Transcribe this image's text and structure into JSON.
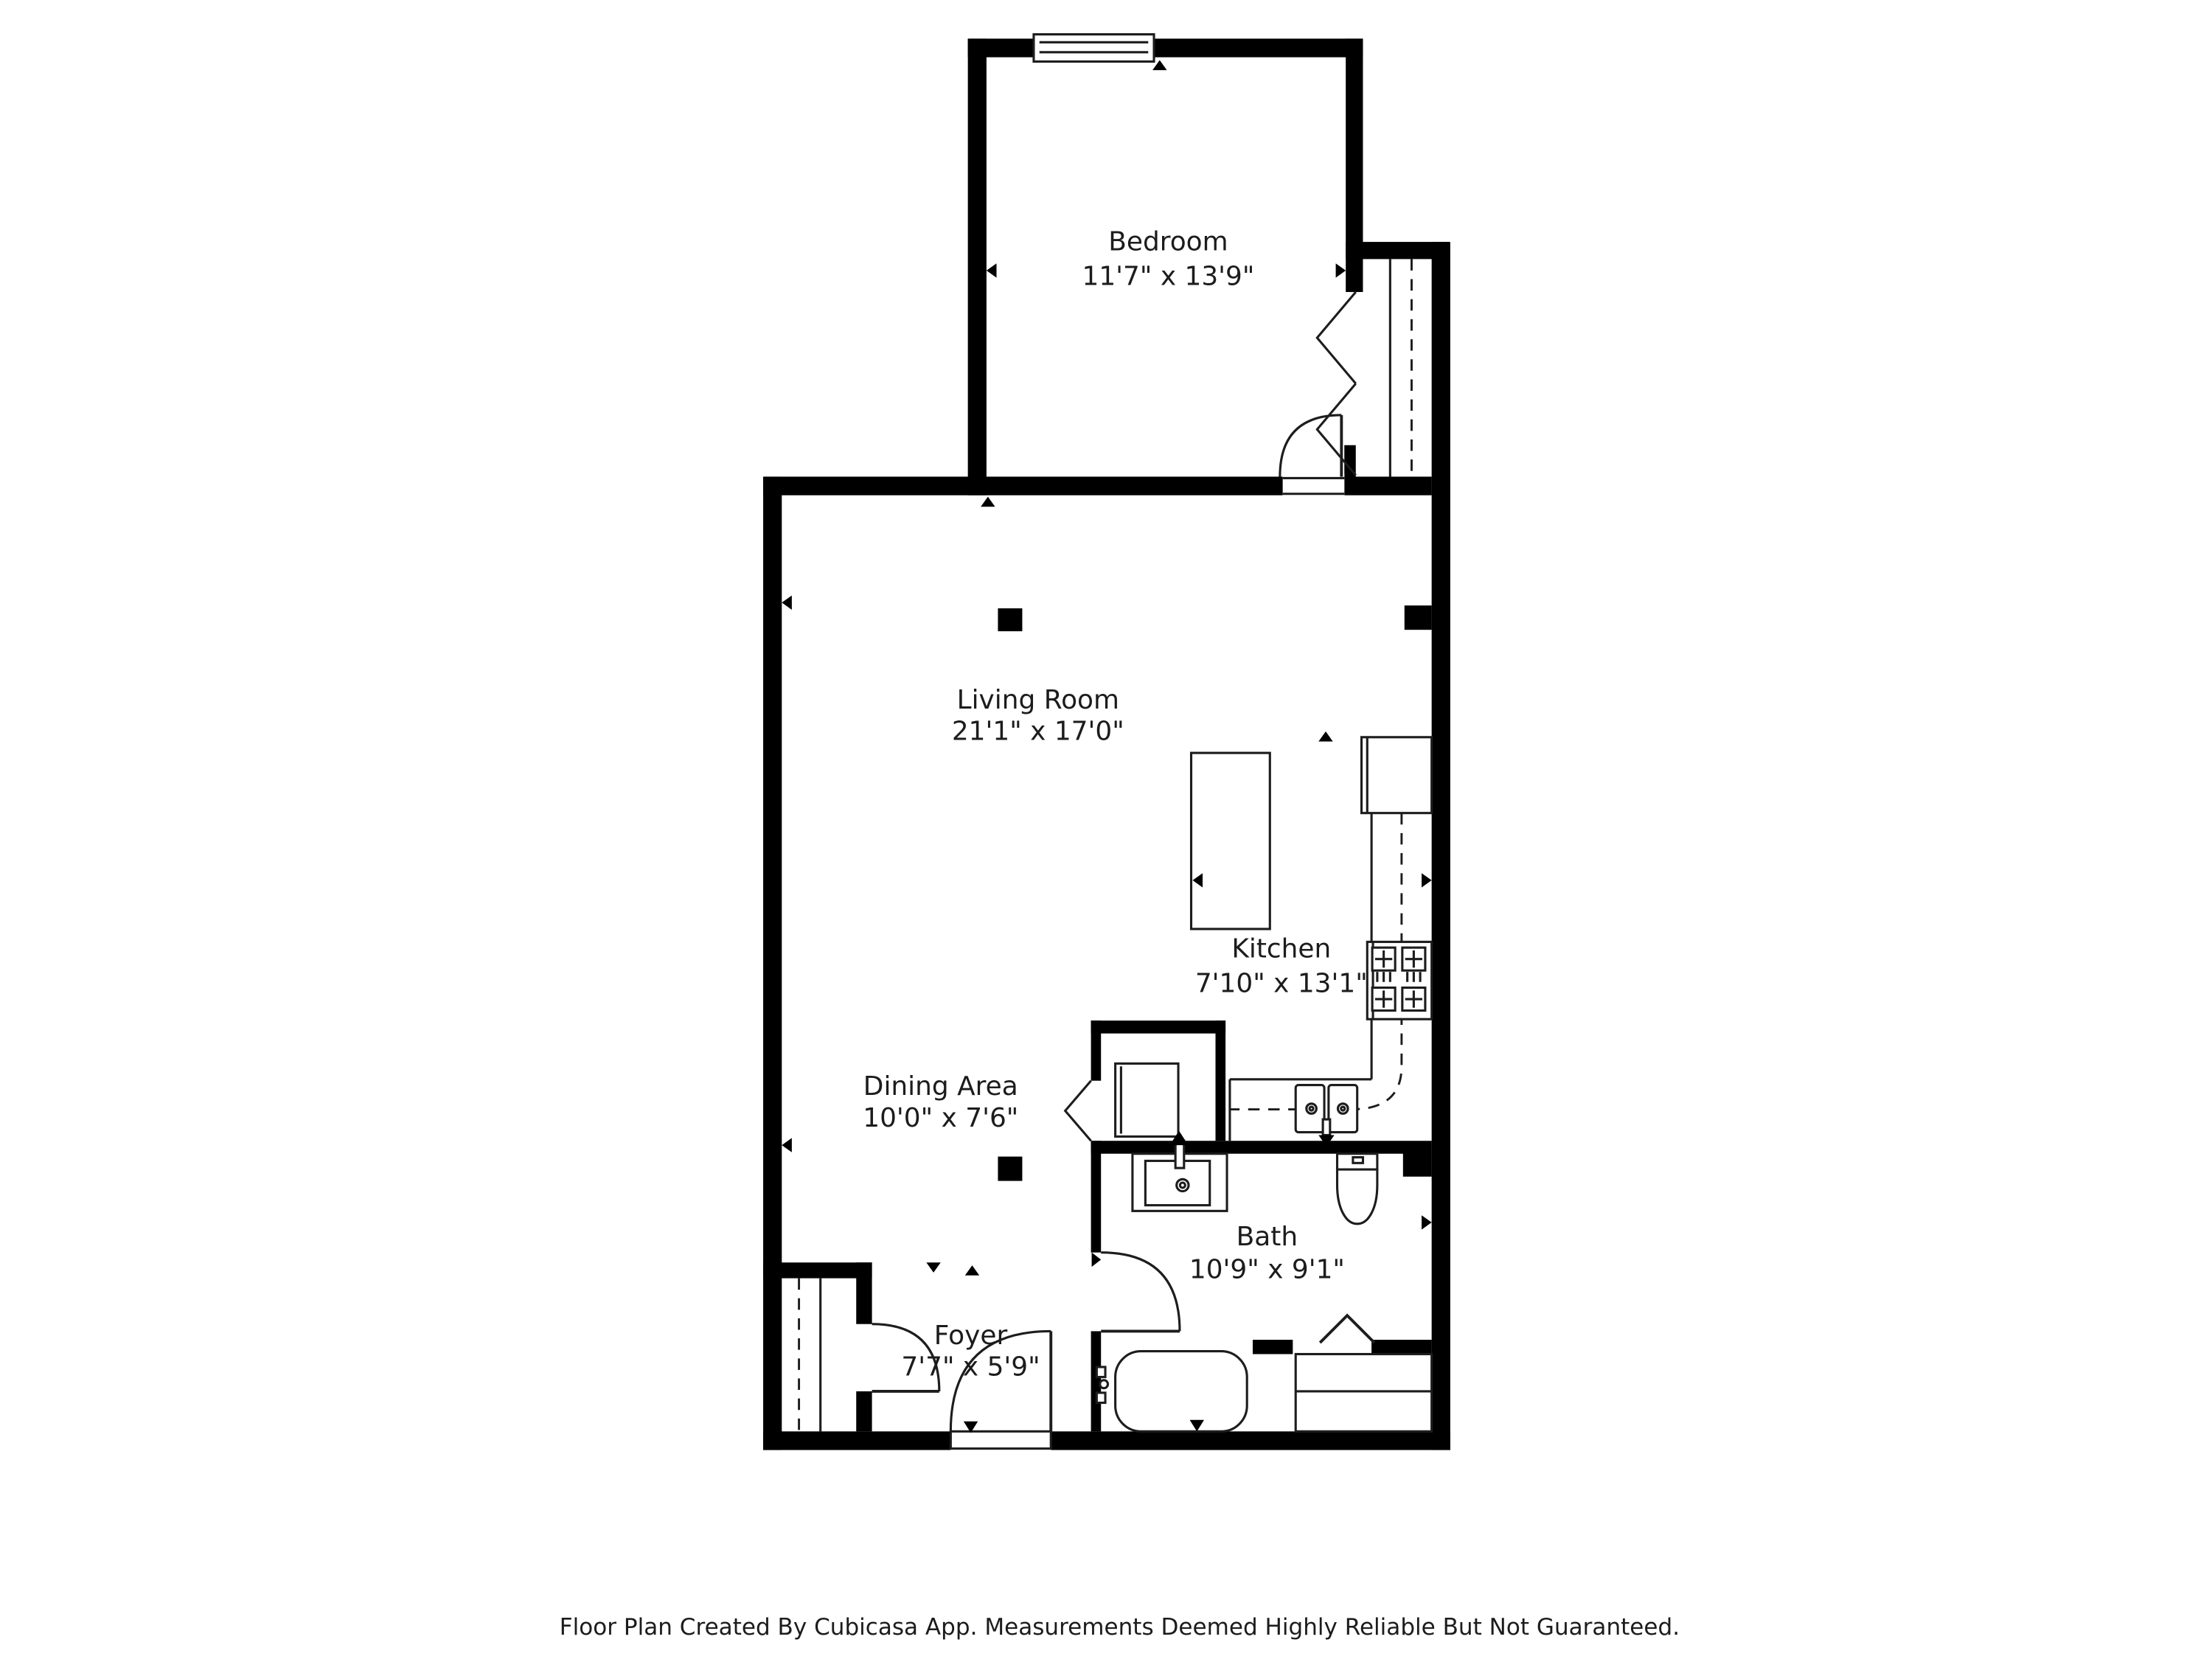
{
  "page": {
    "background": "#ffffff"
  },
  "colors": {
    "wall": "#000000",
    "line": "#1d1d1d",
    "text": "#1c1c1c"
  },
  "rooms": [
    {
      "id": "bedroom",
      "name": "Bedroom",
      "dimensions": "11'7\" x 13'9\""
    },
    {
      "id": "living-room",
      "name": "Living Room",
      "dimensions": "21'1\" x 17'0\""
    },
    {
      "id": "kitchen",
      "name": "Kitchen",
      "dimensions": "7'10\" x 13'1\""
    },
    {
      "id": "dining-area",
      "name": "Dining Area",
      "dimensions": "10'0\" x 7'6\""
    },
    {
      "id": "bath",
      "name": "Bath",
      "dimensions": "10'9\" x 9'1\""
    },
    {
      "id": "foyer",
      "name": "Foyer",
      "dimensions": "7'7\" x 5'9\""
    }
  ],
  "footer": {
    "text": "Floor Plan Created By Cubicasa App. Measurements Deemed Highly Reliable But Not Guaranteed."
  }
}
